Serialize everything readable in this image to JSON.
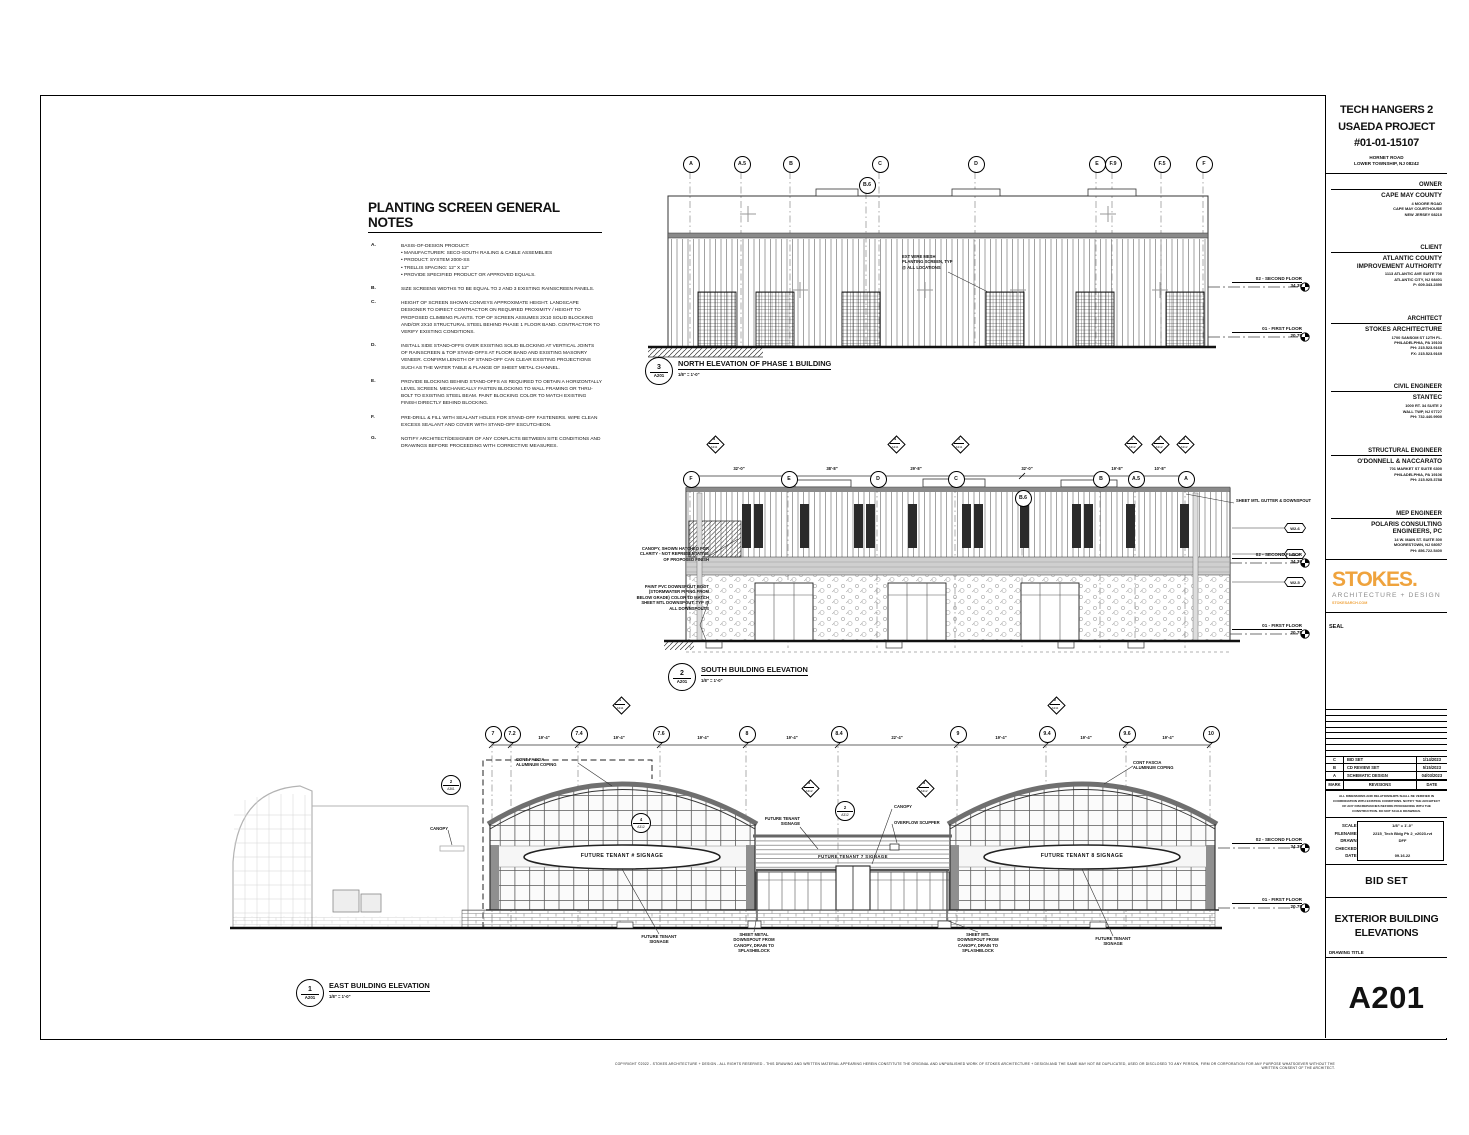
{
  "copyright": "COPYRIGHT ©2022 - STOKES ARCHITECTURE + DESIGN - ALL RIGHTS RESERVED - THIS DRAWING AND WRITTEN MATERIAL APPEARING HEREIN CONSTITUTE THE ORIGINAL AND UNPUBLISHED WORK OF STOKES ARCHITECTURE + DESIGN AND THE SAME MAY NOT BE DUPLICATED, USED OR DISCLOSED TO ANY PERSON, FIRM OR CORPORATION FOR ANY PURPOSE WHATSOEVER WITHOUT THE WRITTEN CONSENT OF THE ARCHITECT.",
  "notes": {
    "title": "PLANTING SCREEN GENERAL NOTES",
    "items": [
      {
        "key": "A.",
        "text": "BASIS-OF-DESIGN PRODUCT:\n•  MANUFACTURER: SECO-SOUTH RAILING & CABLE ASSEMBLIES\n•  PRODUCT: SYSTEM 2000-SS\n•  TRELLIS SPACING: 12\" X 12\"\n•  PROVIDE SPECIFIED PRODUCT OR APPROVED EQUALS."
      },
      {
        "key": "B.",
        "text": "SIZE SCREENS WIDTHS TO BE EQUAL TO 2 AND 3 EXISTING RAINSCREEN PANELS."
      },
      {
        "key": "C.",
        "text": "HEIGHT OF SCREEN SHOWN CONVEYS APPROXIMATE HEIGHT. LANDSCAPE DESIGNER TO DIRECT CONTRACTOR ON REQUIRED PROXIMITY / HEIGHT TO PROPOSED CLIMBING PLANTS. TOP OF SCREEN ASSUMES 2X10 SOLID BLOCKING AND/OR 2X10 STRUCTURAL STEEL BEHIND PHASE 1 FLOOR BAND. CONTRACTOR TO VERIFY EXISTING CONDITIONS."
      },
      {
        "key": "D.",
        "text": "INSTALL SIDE STAND-OFFS OVER EXISTING SOLID BLOCKING AT VERTICAL JOINTS OF RAINSCREEN & TOP STAND-OFFS AT FLOOR BAND AND EXISTING MASONRY VENEER. CONFIRM LENGTH OF STAND-OFF CAN CLEAR EXISTING PROJECTIONS SUCH AS THE WATER TABLE & FLANGE OF SHEET METAL CHANNEL."
      },
      {
        "key": "E.",
        "text": "PROVIDE BLOCKING BEHIND STAND-OFFS AS REQUIRED TO OBTAIN A HORIZONTALLY LEVEL SCREEN. MECHANICALLY FASTEN BLOCKING TO WALL FRAMING OR THRU-BOLT TO EXISTING STEEL BEAM. PAINT BLOCKING COLOR TO MATCH EXISTING FINISH DIRECTLY BEHIND BLOCKING."
      },
      {
        "key": "F.",
        "text": "PRE-DRILL & FILL WITH SEALANT HOLES FOR STAND-OFF FASTENERS. WIPE CLEAN EXCESS SEALANT AND COVER WITH STAND-OFF ESCUTCHEON."
      },
      {
        "key": "G.",
        "text": "NOTIFY ARCHITECT/DESIGNER OF ANY CONFLICTS BETWEEN SITE CONDITIONS AND DRAWINGS BEFORE PROCEEDING WITH CORRECTIVE MEASURES."
      }
    ]
  },
  "levels": {
    "second": {
      "name": "02 - SECOND FLOOR",
      "elev": "34.39"
    },
    "first": {
      "name": "01 - FIRST FLOOR",
      "elev": "20.75"
    }
  },
  "north": {
    "tag": {
      "num": "3",
      "sheet": "A201",
      "title": "NORTH ELEVATION OF PHASE 1 BUILDING",
      "scale": "1/8\" = 1'-0\""
    },
    "grid": [
      "A",
      "A.5",
      "B",
      "B.6",
      "C",
      "D",
      "E",
      "F.9",
      "F.5",
      "F"
    ],
    "callout": "EXT WIRE MESH\nPLANTING SCREEN, TYP\n@ ALL LOCATIONS"
  },
  "south": {
    "tag": {
      "num": "2",
      "sheet": "A201",
      "title": "SOUTH BUILDING ELEVATION",
      "scale": "1/8\" = 1'-0\""
    },
    "grid": [
      "F",
      "E",
      "D",
      "C",
      "B.6",
      "B",
      "A.5",
      "A"
    ],
    "dims": [
      "32'-0\"",
      "38'-8\"",
      "29'-8\"",
      "32'-0\"",
      "19'-8\"",
      "10'-8\""
    ],
    "markers": [
      {
        "num": "3",
        "ref": "A311"
      },
      {
        "num": "4",
        "ref": "A311"
      },
      {
        "num": "1",
        "ref": "A311"
      },
      {
        "num": "1",
        "ref": "A312"
      },
      {
        "num": "2",
        "ref": "A312"
      },
      {
        "num": "4",
        "ref": "A312"
      }
    ],
    "window_tags": [
      "W2-6",
      "W2-4",
      "W2-5"
    ],
    "callouts": {
      "canopy": "CANOPY, SHOWN HATCHED FOR\nCLARITY - NOT REPRESENTATIVE\nOF PROPOSED FINISH",
      "boot": "PAINT PVC DOWNSPOUT BOOT\n(STORMWATER PIPING FROM\nBELOW GRADE) COLOR TO MATCH\nSHEET MTL DOWNSPOUT, TYP @\nALL DOWNSPOUTS",
      "gutter": "SHEET MTL GUTTER & DOWNSPOUT"
    }
  },
  "east": {
    "tag": {
      "num": "1",
      "sheet": "A201",
      "title": "EAST BUILDING ELEVATION",
      "scale": "1/8\" = 1'-0\""
    },
    "grid": [
      "7",
      "7.2",
      "7.4",
      "7.6",
      "8",
      "8.4",
      "9",
      "9.4",
      "9.6",
      "10"
    ],
    "dims": [
      "19'-4\"",
      "19'-4\"",
      "19'-4\"",
      "19'-4\"",
      "22'-4\"",
      "19'-4\"",
      "19'-4\"",
      "19'-4\""
    ],
    "markers": [
      {
        "num": "1",
        "ref": "A311"
      },
      {
        "num": "2",
        "ref": "A311"
      },
      {
        "num": "3",
        "ref": "A312"
      },
      {
        "num": "3",
        "ref": "A312"
      }
    ],
    "circle_markers": [
      {
        "num": "2",
        "ref": "A312"
      },
      {
        "num": "4",
        "ref": "A312"
      },
      {
        "num": "2",
        "ref": "A361"
      }
    ],
    "signs": [
      "FUTURE TENANT # SIGNAGE",
      "FUTURE TENANT 7 SIGNAGE",
      "FUTURE TENANT 8 SIGNAGE"
    ],
    "callouts": {
      "coping_left": "CONT FASCIA\nALUMINUM COPING",
      "coping_right": "CONT FASCIA\nALUMINUM COPING",
      "canopy_left": "CANOPY",
      "canopy_mid": "CANOPY",
      "scupper": "OVERFLOW SCUPPER",
      "tenant_top": "FUTURE TENANT\nSIGNAGE",
      "tenant_left": "FUTURE TENANT\nSIGNAGE",
      "tenant_right": "FUTURE TENANT\nSIGNAGE",
      "ds_left": "SHEET METAL\nDOWNSPOUT FROM\nCANOPY, DRAIN TO\nSPLASHBLOCK",
      "ds_right": "SHEET MTL\nDOWNSPOUT FROM\nCANOPY, DRAIN TO\nSPLASHBLOCK"
    }
  },
  "titleblock": {
    "project": {
      "title": "TECH HANGERS 2\nUSAEDA PROJECT\n#01-01-15107",
      "address": "HORNET ROAD\nLOWER TOWNSHIP, NJ 08242"
    },
    "consultants": [
      {
        "role": "OWNER",
        "name": "CAPE MAY COUNTY",
        "lines": "4 MOORE ROAD\nCAPE MAY COURTHOUSE\nNEW JERSEY 08210"
      },
      {
        "role": "CLIENT",
        "name": "ATLANTIC COUNTY\nIMPROVEMENT AUTHORITY",
        "lines": "1113 ATLANTIC AVE SUITE 700\nATLANTIC CITY, NJ 08401\nP: 609.343.2390"
      },
      {
        "role": "ARCHITECT",
        "name": "STOKES ARCHITECTURE",
        "lines": "1700 SANSOM ST 12TH FL.\nPHILADELPHIA, PA 19103\nPH: 215.523.9160\nFX: 215.523.9169"
      },
      {
        "role": "CIVIL ENGINEER",
        "name": "STANTEC",
        "lines": "1000 RT. 34 SUITE 2\nWALL TWP, NJ 07727\nPH: 732.440.9900"
      },
      {
        "role": "STRUCTURAL ENGINEER",
        "name": "O'DONNELL & NACCARATO",
        "lines": "701 MARKET ST SUITE 6300\nPHILADELPHIA, PA 19106\nPH: 215.925.3788"
      },
      {
        "role": "MEP ENGINEER",
        "name": "POLARIS CONSULTING\nENGINEERS, PC",
        "lines": "14 W. MAIN ST. SUITE 300\nMOORESTOWN, NJ 08057\nPH: 856.722.5400"
      }
    ],
    "logo": {
      "word": "STOKES.",
      "tagline": "ARCHITECTURE + DESIGN",
      "url": "STOKESARCH.COM",
      "accent": "#EFA33D"
    },
    "seal_label": "SEAL",
    "revisions": {
      "headers": [
        "MARK",
        "REVISIONS",
        "DATE"
      ],
      "rows": [
        {
          "mark": "C",
          "desc": "BID SET",
          "date": "1/14/2023"
        },
        {
          "mark": "B",
          "desc": "CD REVIEW SET",
          "date": "5/15/2023"
        },
        {
          "mark": "A",
          "desc": "SCHEMATIC DESIGN",
          "date": "04/03/2023"
        }
      ]
    },
    "disclaimer": "ALL DIMENSIONS AND RELATIONSHIPS SHALL BE VERIFIED IN COORDINATION WITH EXISTING CONDITIONS. NOTIFY THE ARCHITECT OF ANY DISCREPANCIES BEFORE PROCEEDING WITH THE CONSTRUCTION. DO NOT SCALE DRAWINGS.",
    "info": {
      "scale_label": "SCALE:",
      "scale": "1/8\" = 1'-0\"",
      "filename_label": "FILENAME:",
      "filename": "2215_Tech Bldg Ph 2_v2023.rvt",
      "drawn_label": "DRAWN:",
      "drawn": "DFF",
      "checked_label": "CHECKED:",
      "checked": "",
      "date_label": "DATE:",
      "date": "09.16.22"
    },
    "issue": "BID SET",
    "drawing_title": "EXTERIOR BUILDING\nELEVATIONS",
    "drawing_title_label": "DRAWING TITLE",
    "sheet_number": "A201"
  }
}
